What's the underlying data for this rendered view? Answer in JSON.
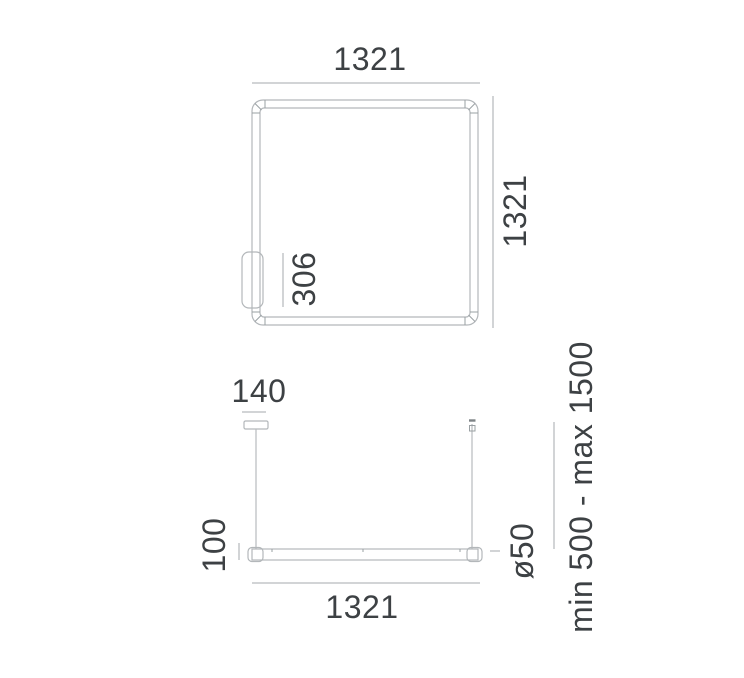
{
  "drawing": {
    "colors": {
      "background": "#ffffff",
      "outline_line": "#b3b7ba",
      "dimension_line": "#a4a9ac",
      "label_text": "#3d4144"
    },
    "top_view": {
      "width_label": "1321",
      "height_label": "1321",
      "driver_length_label": "306"
    },
    "front_view": {
      "canopy_width_label": "140",
      "body_height_label": "100",
      "length_label": "1321",
      "diameter_label": "ø50",
      "suspension_range_label": "min 500 - max 1500"
    }
  }
}
